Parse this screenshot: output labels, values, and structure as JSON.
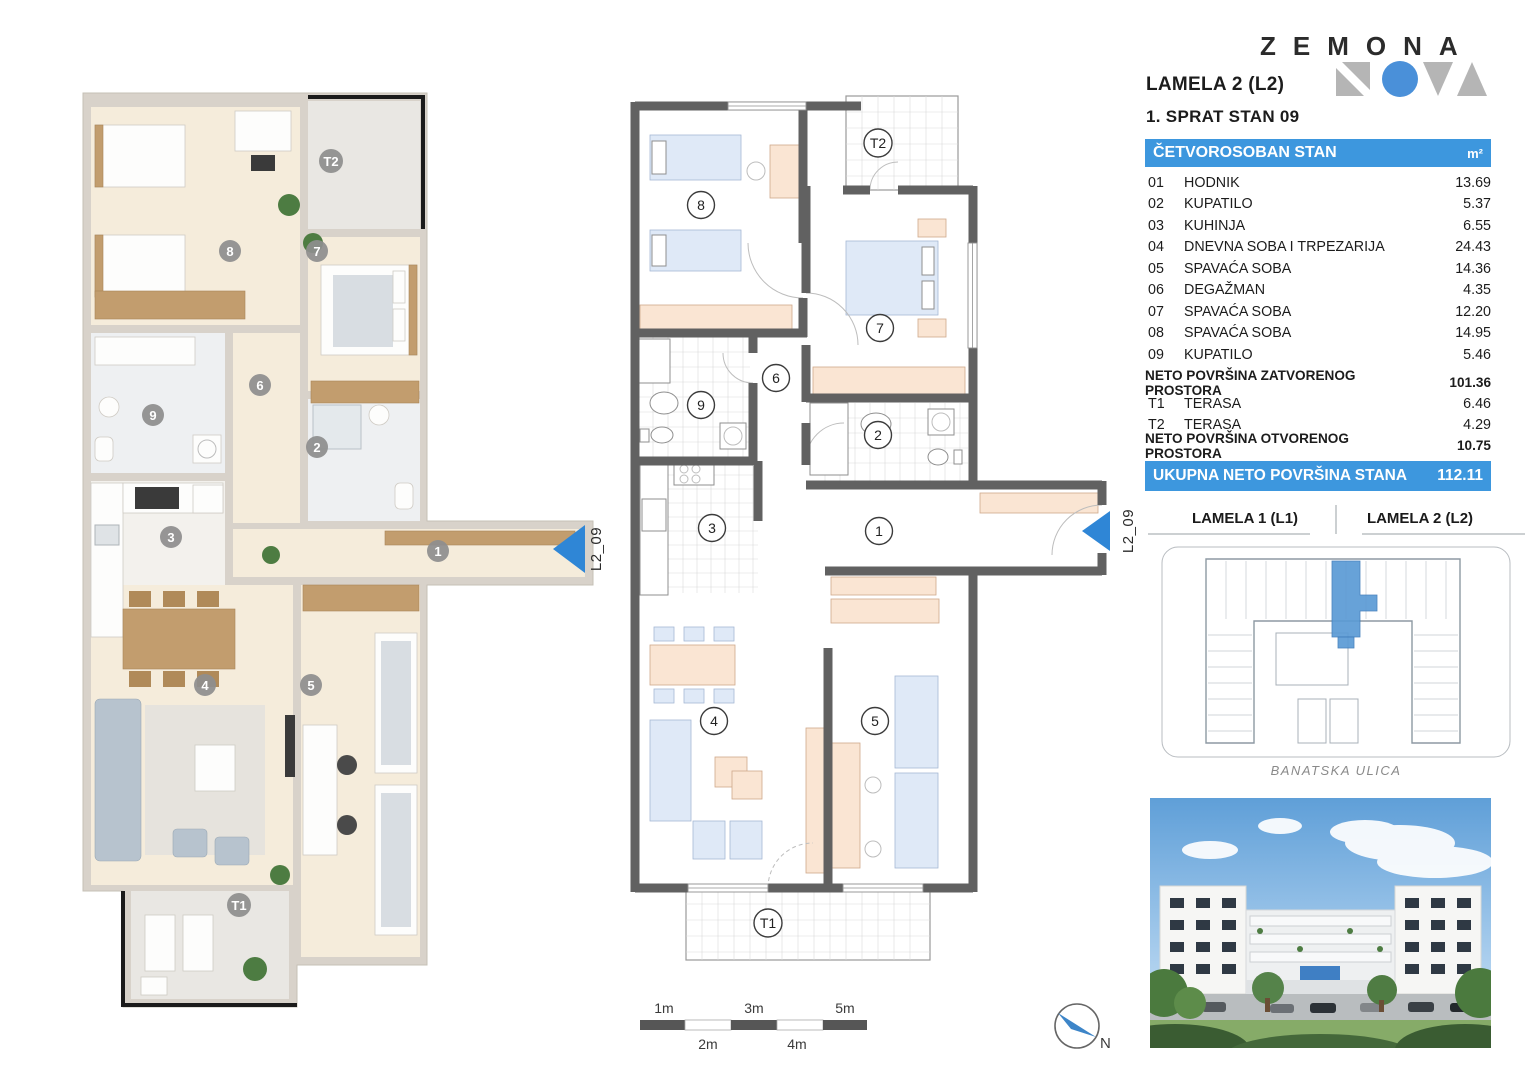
{
  "logo": {
    "wordmark": "ZEMONA",
    "mark_shapes": [
      "square-n-icon",
      "circle-o-icon",
      "triangle-v-icon",
      "triangle-a-icon"
    ],
    "blue": "#4a90d9",
    "gray": "#b5b5b5"
  },
  "header": {
    "building": "LAMELA 2 (L2)",
    "floor_unit": "1. SPRAT STAN 09"
  },
  "area_table": {
    "title": "ČETVOROSOBAN STAN",
    "unit": "m²",
    "rows": [
      {
        "num": "01",
        "name": "HODNIK",
        "area": "13.69"
      },
      {
        "num": "02",
        "name": "KUPATILO",
        "area": "5.37"
      },
      {
        "num": "03",
        "name": "KUHINJA",
        "area": "6.55"
      },
      {
        "num": "04",
        "name": "DNEVNA SOBA I TRPEZARIJA",
        "area": "24.43"
      },
      {
        "num": "05",
        "name": "SPAVAĆA SOBA",
        "area": "14.36"
      },
      {
        "num": "06",
        "name": "DEGAŽMAN",
        "area": "4.35"
      },
      {
        "num": "07",
        "name": "SPAVAĆA SOBA",
        "area": "12.20"
      },
      {
        "num": "08",
        "name": "SPAVAĆA SOBA",
        "area": "14.95"
      },
      {
        "num": "09",
        "name": "KUPATILO",
        "area": "5.46"
      }
    ],
    "closed_label": "NETO POVRŠINA ZATVORENOG PROSTORA",
    "closed_value": "101.36",
    "terrace_rows": [
      {
        "num": "T1",
        "name": "TERASA",
        "area": "6.46"
      },
      {
        "num": "T2",
        "name": "TERASA",
        "area": "4.29"
      }
    ],
    "open_label": "NETO POVRŠINA OTVORENOG PROSTORA",
    "open_value": "10.75",
    "total_label": "UKUPNA NETO POVRŠINA STANA",
    "total_value": "112.11"
  },
  "plan_rooms": {
    "r1": "1",
    "r2": "2",
    "r3": "3",
    "r4": "4",
    "r5": "5",
    "r6": "6",
    "r7": "7",
    "r8": "8",
    "r9": "9",
    "t1": "T1",
    "t2": "T2"
  },
  "entrance_label": "L2_09",
  "site_plan": {
    "lamela1": "LAMELA 1 (L1)",
    "lamela2": "LAMELA 2 (L2)",
    "street": "BANATSKA ULICA"
  },
  "scale_bar": {
    "above": [
      "1m",
      "3m",
      "5m"
    ],
    "below": [
      "2m",
      "4m"
    ]
  },
  "compass": {
    "north": "N"
  },
  "colors": {
    "accent_blue": "#3d97de",
    "highlight_blue": "#5b9bd5",
    "wall_gray": "#616161",
    "furniture_peach": "#fae5d3",
    "furniture_blue": "#dfe9f7"
  }
}
